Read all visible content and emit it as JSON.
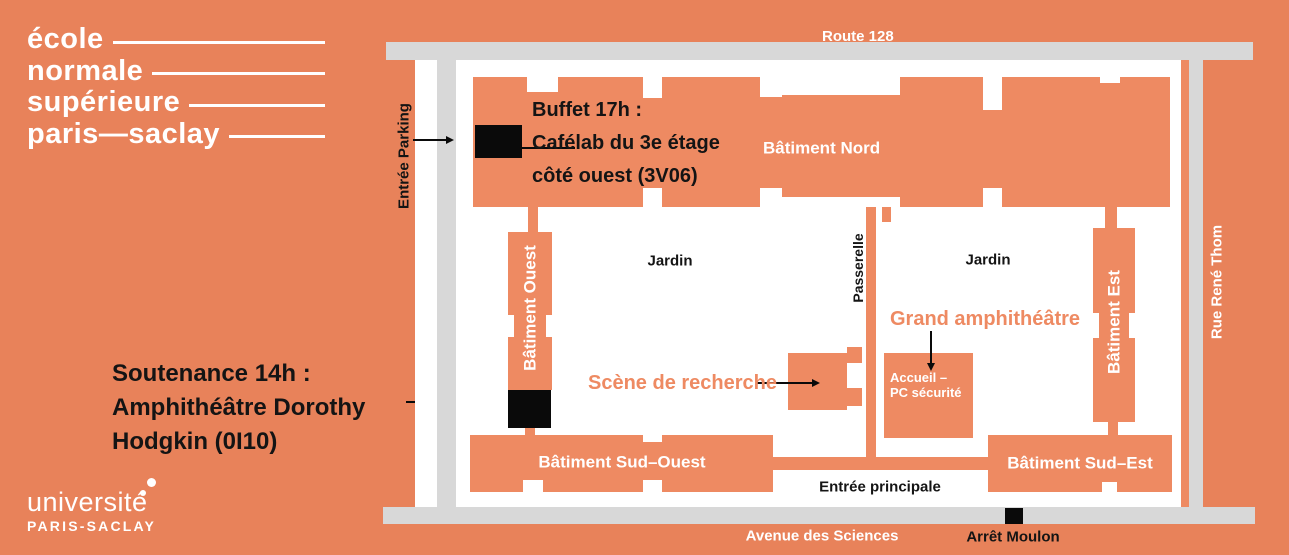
{
  "colors": {
    "background": "#E8825A",
    "building": "#EE8A62",
    "road": "#D8D8D8",
    "marker": "#0A0A0A",
    "accent_text": "#EE8A62",
    "text_light": "#FFFFFF",
    "text_dark": "#141414"
  },
  "ens_logo": {
    "lines": [
      "école",
      "normale",
      "supérieure",
      "paris—saclay"
    ]
  },
  "ups_logo": {
    "line1": "université",
    "line2": "PARIS-SACLAY"
  },
  "soutenance_note": {
    "lines": [
      "Soutenance 14h :",
      "Amphithéâtre Dorothy",
      "Hodgkin (0I10)"
    ]
  },
  "buffet_note": {
    "lines": [
      "Buffet 17h :",
      "Cafélab du 3e étage",
      "côté ouest (3V06)"
    ]
  },
  "map": {
    "roads": {
      "top": "Route 128",
      "bottom": "Avenue des Sciences",
      "right": "Rue René Thom"
    },
    "labels": {
      "entree_parking": "Entrée Parking",
      "batiment_nord": "Bâtiment Nord",
      "jardin_west": "Jardin",
      "jardin_east": "Jardin",
      "passerelle": "Passerelle",
      "batiment_ouest": "Bâtiment Ouest",
      "batiment_est": "Bâtiment Est",
      "grand_amphitheatre": "Grand amphithéâtre",
      "scene_de_recherche": "Scène de recherche",
      "accueil_line1": "Accueil –",
      "accueil_line2": "PC sécurité",
      "batiment_sud_ouest": "Bâtiment Sud–Ouest",
      "batiment_sud_est": "Bâtiment Sud–Est",
      "entree_principale": "Entrée principale",
      "arret_moulon": "Arrêt Moulon",
      "stop_marker": "Arrêt Moulon bus stop marker",
      "buffet_marker": "Cafélab location marker",
      "soutenance_marker": "Amphithéâtre Dorothy Hodgkin location marker"
    }
  }
}
